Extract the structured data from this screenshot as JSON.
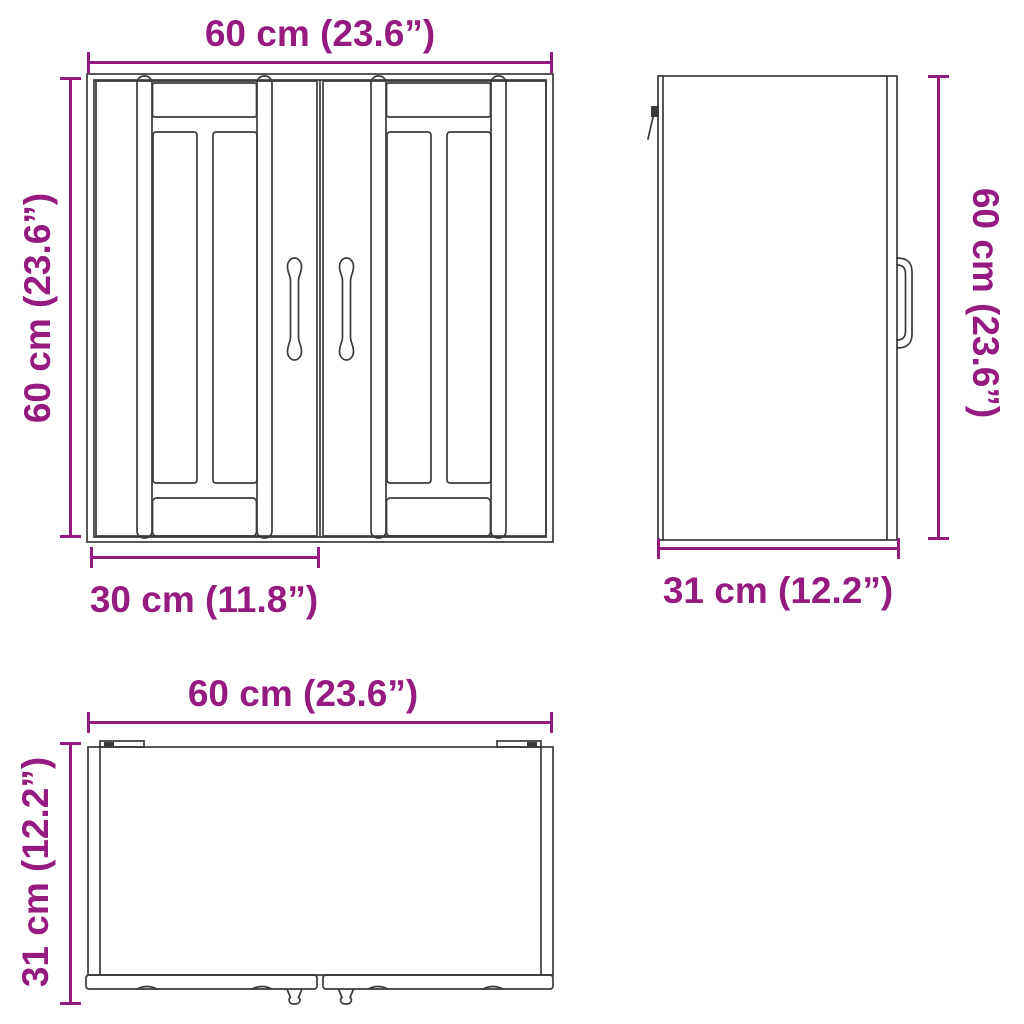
{
  "diagram": {
    "colors": {
      "accent": "#951B81",
      "line": "#3a3a3a",
      "background": "#ffffff"
    },
    "views": {
      "front": {
        "width": "60 cm (23.6”)",
        "height": "60 cm (23.6”)",
        "door_width": "30 cm (11.8”)"
      },
      "side": {
        "height": "60 cm (23.6”)",
        "depth": "31 cm (12.2”)"
      },
      "top": {
        "width": "60 cm (23.6”)",
        "depth": "31 cm (12.2”)"
      }
    }
  }
}
